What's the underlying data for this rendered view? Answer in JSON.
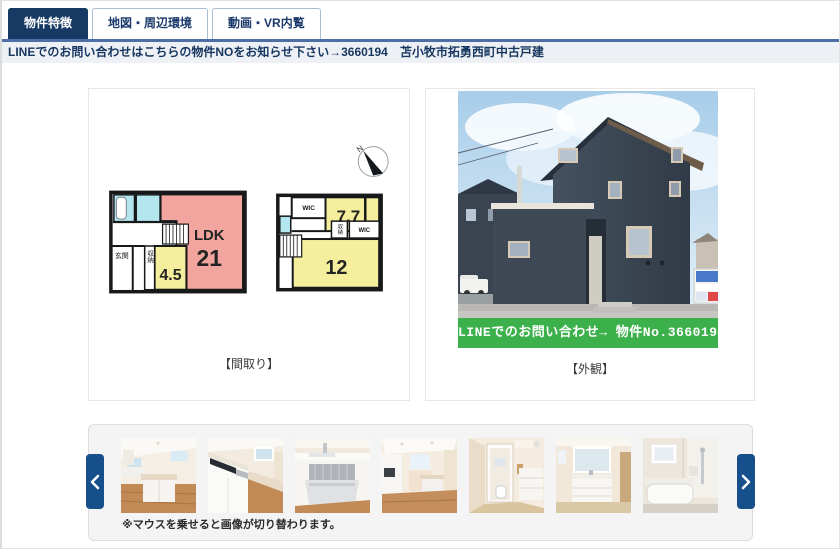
{
  "tabs": [
    {
      "label": "物件特徴",
      "active": true
    },
    {
      "label": "地図・周辺環境",
      "active": false
    },
    {
      "label": "動画・VR内覧",
      "active": false
    }
  ],
  "notice": {
    "text": "LINEでのお問い合わせはこちらの物件NOをお知らせ下さい→3660194　苫小牧市拓勇西町中古戸建"
  },
  "floorplan": {
    "caption": "【間取り】",
    "compass": "N",
    "floor1": {
      "ldk": "LDK",
      "ldk_size": "21",
      "western_size": "4.5",
      "entrance": "玄関",
      "storage": "収納"
    },
    "floor2": {
      "wic": "WIC",
      "room_a_size": "7.7",
      "room_b_size": "12",
      "storage": "収納",
      "wic2": "WIC"
    }
  },
  "exterior": {
    "caption": "【外観】",
    "banner": "LINEでのお問い合わせ→ 物件No.3660194"
  },
  "gallery": {
    "note": "※マウスを乗せると画像が切り替わります。",
    "thumbnails": [
      {
        "name": "kitchen-island"
      },
      {
        "name": "kitchen-counter"
      },
      {
        "name": "kitchen-drawer"
      },
      {
        "name": "kitchen-dining"
      },
      {
        "name": "washroom-hallway"
      },
      {
        "name": "vanity"
      },
      {
        "name": "bathroom"
      }
    ]
  },
  "icons": {
    "prev": "chevron-left-icon",
    "next": "chevron-right-icon",
    "compass": "north-arrow-icon"
  },
  "colors": {
    "tab_active_bg": "#173a64",
    "tab_text": "#1b3a6b",
    "tab_border": "#a9bdd9",
    "tab_underline": "#4d6fa6",
    "notice_bg": "#edf1f6",
    "notice_text": "#16365f",
    "arrow_bg": "#174e8c",
    "banner_green": "#3cb04a",
    "plan_pink": "#f2a49e",
    "plan_yellow": "#f5ef9d",
    "plan_cyan": "#b4e6ef"
  }
}
